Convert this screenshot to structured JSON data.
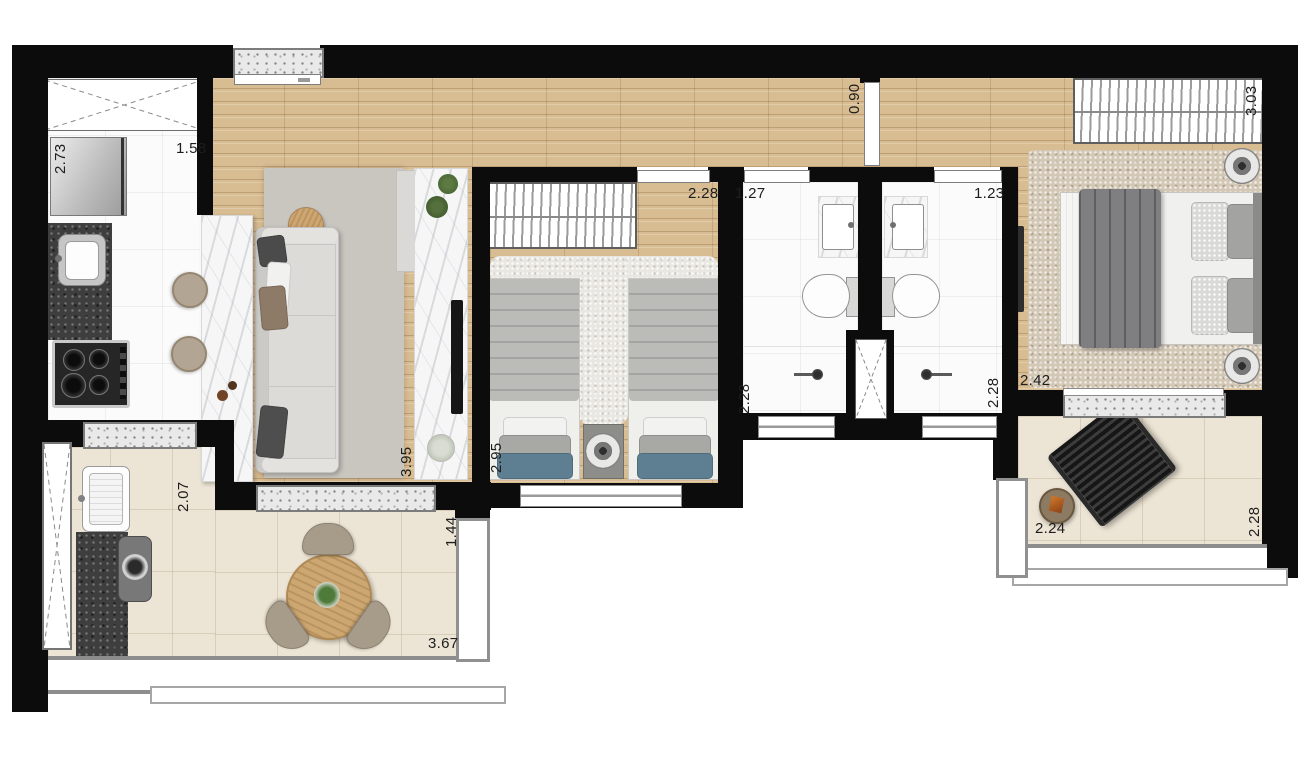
{
  "plan": {
    "type": "apartment-floor-plan",
    "unit_style": "top-down furnished render",
    "dims": [
      {
        "id": "kitchen-depth",
        "value": "2.73"
      },
      {
        "id": "kitchen-width",
        "value": "1.58"
      },
      {
        "id": "hall-door-width",
        "value": "0.90"
      },
      {
        "id": "master-wardrobe-width",
        "value": "3.03"
      },
      {
        "id": "bedroom2-width",
        "value": "2.28"
      },
      {
        "id": "bath1-width",
        "value": "1.27"
      },
      {
        "id": "bath2-width",
        "value": "1.23"
      },
      {
        "id": "bath1-depth",
        "value": "2.28"
      },
      {
        "id": "bath2-depth",
        "value": "2.28"
      },
      {
        "id": "master-width",
        "value": "2.42"
      },
      {
        "id": "living-depth",
        "value": "3.95"
      },
      {
        "id": "bedroom2-depth",
        "value": "2.95"
      },
      {
        "id": "balcony-left-depth",
        "value": "2.07"
      },
      {
        "id": "balcony-right-depth",
        "value": "1.44"
      },
      {
        "id": "balcony-width",
        "value": "3.67"
      },
      {
        "id": "balcony2-width",
        "value": "2.24"
      },
      {
        "id": "balcony2-depth",
        "value": "2.28"
      }
    ],
    "palette": {
      "wall": "#0c0c0c",
      "wood_floor": "#d8bc92",
      "white_tile": "#fbfbfb",
      "balcony_tile": "#ece4d4",
      "granite_counter": "#3e3e3e",
      "marble_counter": "#f6f6f6",
      "accent_blue_bedding": "#5d7f91",
      "label_text": "#1d1d1d"
    }
  }
}
